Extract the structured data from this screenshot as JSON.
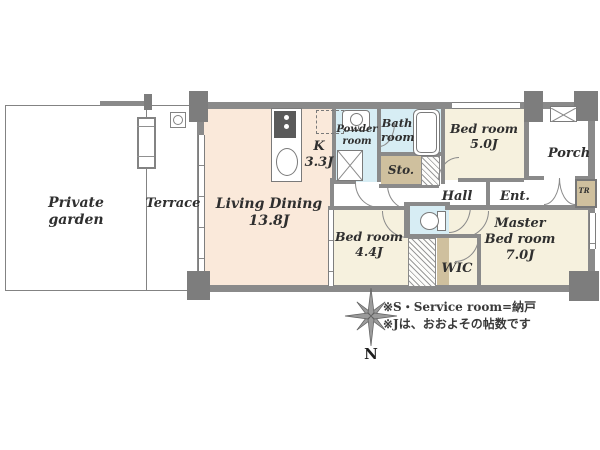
{
  "plan": {
    "outdoor": {
      "private_garden": {
        "label": "Private garden"
      },
      "terrace": {
        "label": "Terrace"
      }
    },
    "rooms": {
      "living_dining": {
        "label": "Living Dining",
        "size": "13.8J"
      },
      "kitchen": {
        "label": "K",
        "size": "3.3J"
      },
      "powder_room": {
        "label": "Powder room"
      },
      "bath_room": {
        "label": "Bath room"
      },
      "bedroom_5": {
        "label": "Bed room",
        "size": "5.0J"
      },
      "porch": {
        "label": "Porch"
      },
      "storage": {
        "label": "Sto."
      },
      "hall": {
        "label": "Hall"
      },
      "entrance": {
        "label": "Ent."
      },
      "trunk_room": {
        "label": "TR"
      },
      "bedroom_4": {
        "label": "Bed room",
        "size": "4.4J"
      },
      "wic": {
        "label": "WIC"
      },
      "master_bedroom": {
        "label": "Master Bed room",
        "size": "7.0J"
      }
    },
    "compass": {
      "label": "N"
    },
    "notes": [
      "※S・Service room=納戸",
      "※Jは、おおよその帖数です"
    ],
    "colors": {
      "living_dining_fill": "#fae9da",
      "bedroom_fill": "#f6f1de",
      "wet_area_fill": "#d7edf4",
      "storage_fill": "#cfc09e",
      "wall": "#8a8a8a",
      "pillar": "#7d7d7d",
      "line": "#909090",
      "text": "#2f2f2f"
    }
  }
}
